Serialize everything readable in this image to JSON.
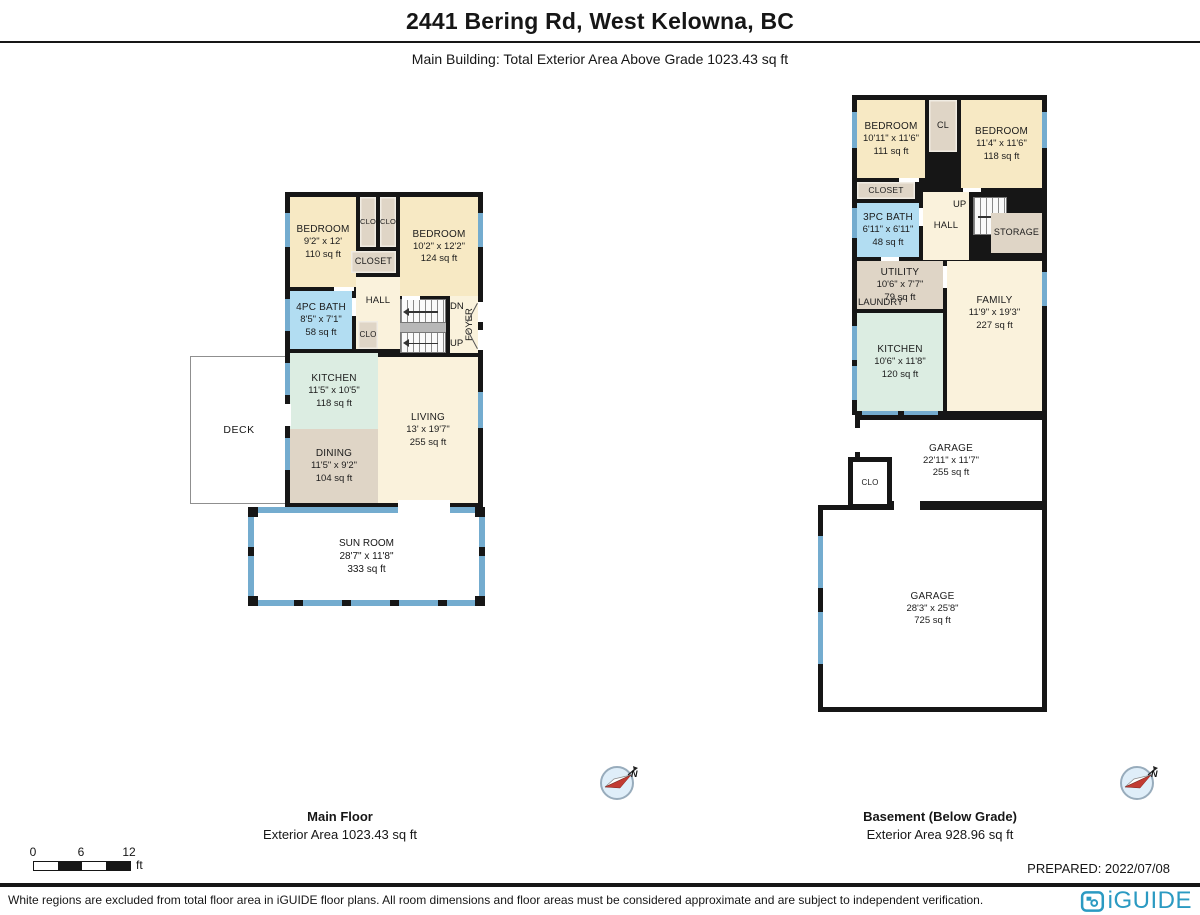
{
  "header": {
    "title": "2441 Bering Rd, West Kelowna, BC",
    "subtitle": "Main Building: Total Exterior Area Above Grade 1023.43 sq ft"
  },
  "main_floor": {
    "caption_title": "Main Floor",
    "caption_area": "Exterior Area 1023.43 sq ft",
    "rooms": {
      "bedroom_left": {
        "name": "BEDROOM",
        "dims": "9'2\" x 12'",
        "area": "110 sq ft"
      },
      "clo_a": {
        "name": "CLO"
      },
      "clo_b": {
        "name": "CLO"
      },
      "bedroom_right": {
        "name": "BEDROOM",
        "dims": "10'2\" x 12'2\"",
        "area": "124 sq ft"
      },
      "closet": {
        "name": "CLOSET"
      },
      "bath": {
        "name": "4PC BATH",
        "dims": "8'5\" x 7'1\"",
        "area": "58 sq ft"
      },
      "hall": {
        "name": "HALL"
      },
      "clo_c": {
        "name": "CLO"
      },
      "stairs_down": {
        "label": "DN"
      },
      "stairs_up": {
        "label": "UP"
      },
      "foyer": {
        "name": "FOYER"
      },
      "kitchen": {
        "name": "KITCHEN",
        "dims": "11'5\" x 10'5\"",
        "area": "118 sq ft"
      },
      "deck": {
        "name": "DECK"
      },
      "dining": {
        "name": "DINING",
        "dims": "11'5\" x 9'2\"",
        "area": "104 sq ft"
      },
      "living": {
        "name": "LIVING",
        "dims": "13' x 19'7\"",
        "area": "255 sq ft"
      },
      "sun_room": {
        "name": "SUN ROOM",
        "dims": "28'7\" x 11'8\"",
        "area": "333 sq ft"
      }
    }
  },
  "basement": {
    "caption_title": "Basement (Below Grade)",
    "caption_area": "Exterior Area 928.96 sq ft",
    "rooms": {
      "bedroom_left": {
        "name": "BEDROOM",
        "dims": "10'11\" x 11'6\"",
        "area": "111 sq ft"
      },
      "cl": {
        "name": "CL"
      },
      "bedroom_right": {
        "name": "BEDROOM",
        "dims": "11'4\" x 11'6\"",
        "area": "118 sq ft"
      },
      "closet": {
        "name": "CLOSET"
      },
      "bath": {
        "name": "3PC BATH",
        "dims": "6'11\" x 6'11\"",
        "area": "48 sq ft"
      },
      "hall": {
        "name": "HALL"
      },
      "stairs_up": {
        "label": "UP"
      },
      "storage": {
        "name": "STORAGE"
      },
      "utility": {
        "name": "UTILITY",
        "dims": "10'6\" x 7'7\"",
        "area": "79 sq ft"
      },
      "laundry": {
        "name": "LAUNDRY"
      },
      "family": {
        "name": "FAMILY",
        "dims": "11'9\" x 19'3\"",
        "area": "227 sq ft"
      },
      "kitchen": {
        "name": "KITCHEN",
        "dims": "10'6\" x 11'8\"",
        "area": "120 sq ft"
      },
      "garage_upper": {
        "name": "GARAGE",
        "dims": "22'11\" x 11'7\"",
        "area": "255 sq ft"
      },
      "clo": {
        "name": "CLO"
      },
      "garage_lower": {
        "name": "GARAGE",
        "dims": "28'3\" x 25'8\"",
        "area": "725 sq ft"
      }
    }
  },
  "scale_bar": {
    "tick0": "0",
    "tick1": "6",
    "tick2": "12",
    "unit": "ft"
  },
  "prepared": "PREPARED: 2022/07/08",
  "compass": {
    "north_label": "N"
  },
  "footer": {
    "disclaimer": "White regions are excluded from total floor area in iGUIDE floor plans. All room dimensions and floor areas must be considered approximate and are subject to independent verification.",
    "logo_text": "iGUIDE"
  },
  "colors": {
    "wall": "#161616",
    "window": "#74ACCF",
    "room_cream": "#F7E9C4",
    "room_light_cream": "#FAF2DC",
    "room_tan": "#DFD5C6",
    "room_mint": "#DCEDE2",
    "room_bath_blue": "#B2DDF2",
    "logo_blue": "#2B9AC2",
    "compass_red": "#C23B32"
  }
}
